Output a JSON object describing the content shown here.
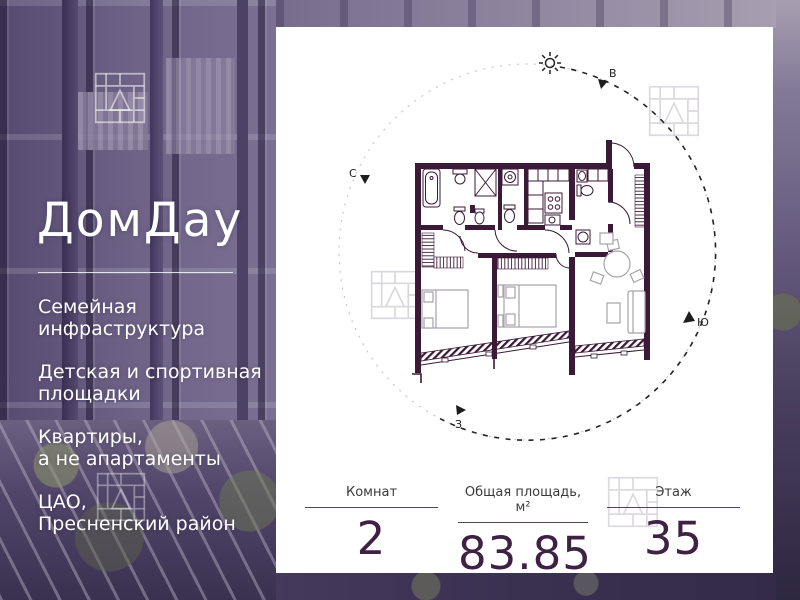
{
  "brand": {
    "logo": "ДомДау"
  },
  "features": [
    {
      "line1": "Семейная",
      "line2": "инфраструктура"
    },
    {
      "line1": "Детская и спортивная",
      "line2": "площадки"
    },
    {
      "line1": "Квартиры,",
      "line2": "а не апартаменты"
    },
    {
      "line1": "ЦАО,",
      "line2": "Пресненский район"
    }
  ],
  "plan": {
    "type": "apartment-floor-plan",
    "compass": {
      "north": "С",
      "east": "В",
      "south": "Ю",
      "west": "З"
    }
  },
  "stats": [
    {
      "label": "Комнат",
      "value": "2"
    },
    {
      "label": "Общая площадь, м²",
      "value": "83.85"
    },
    {
      "label": "Этаж",
      "value": "35"
    }
  ],
  "colors": {
    "wall": "#3a1a36",
    "accent": "#3f2144",
    "card": "#ffffff",
    "photo_overlay": "#6a5e82"
  }
}
